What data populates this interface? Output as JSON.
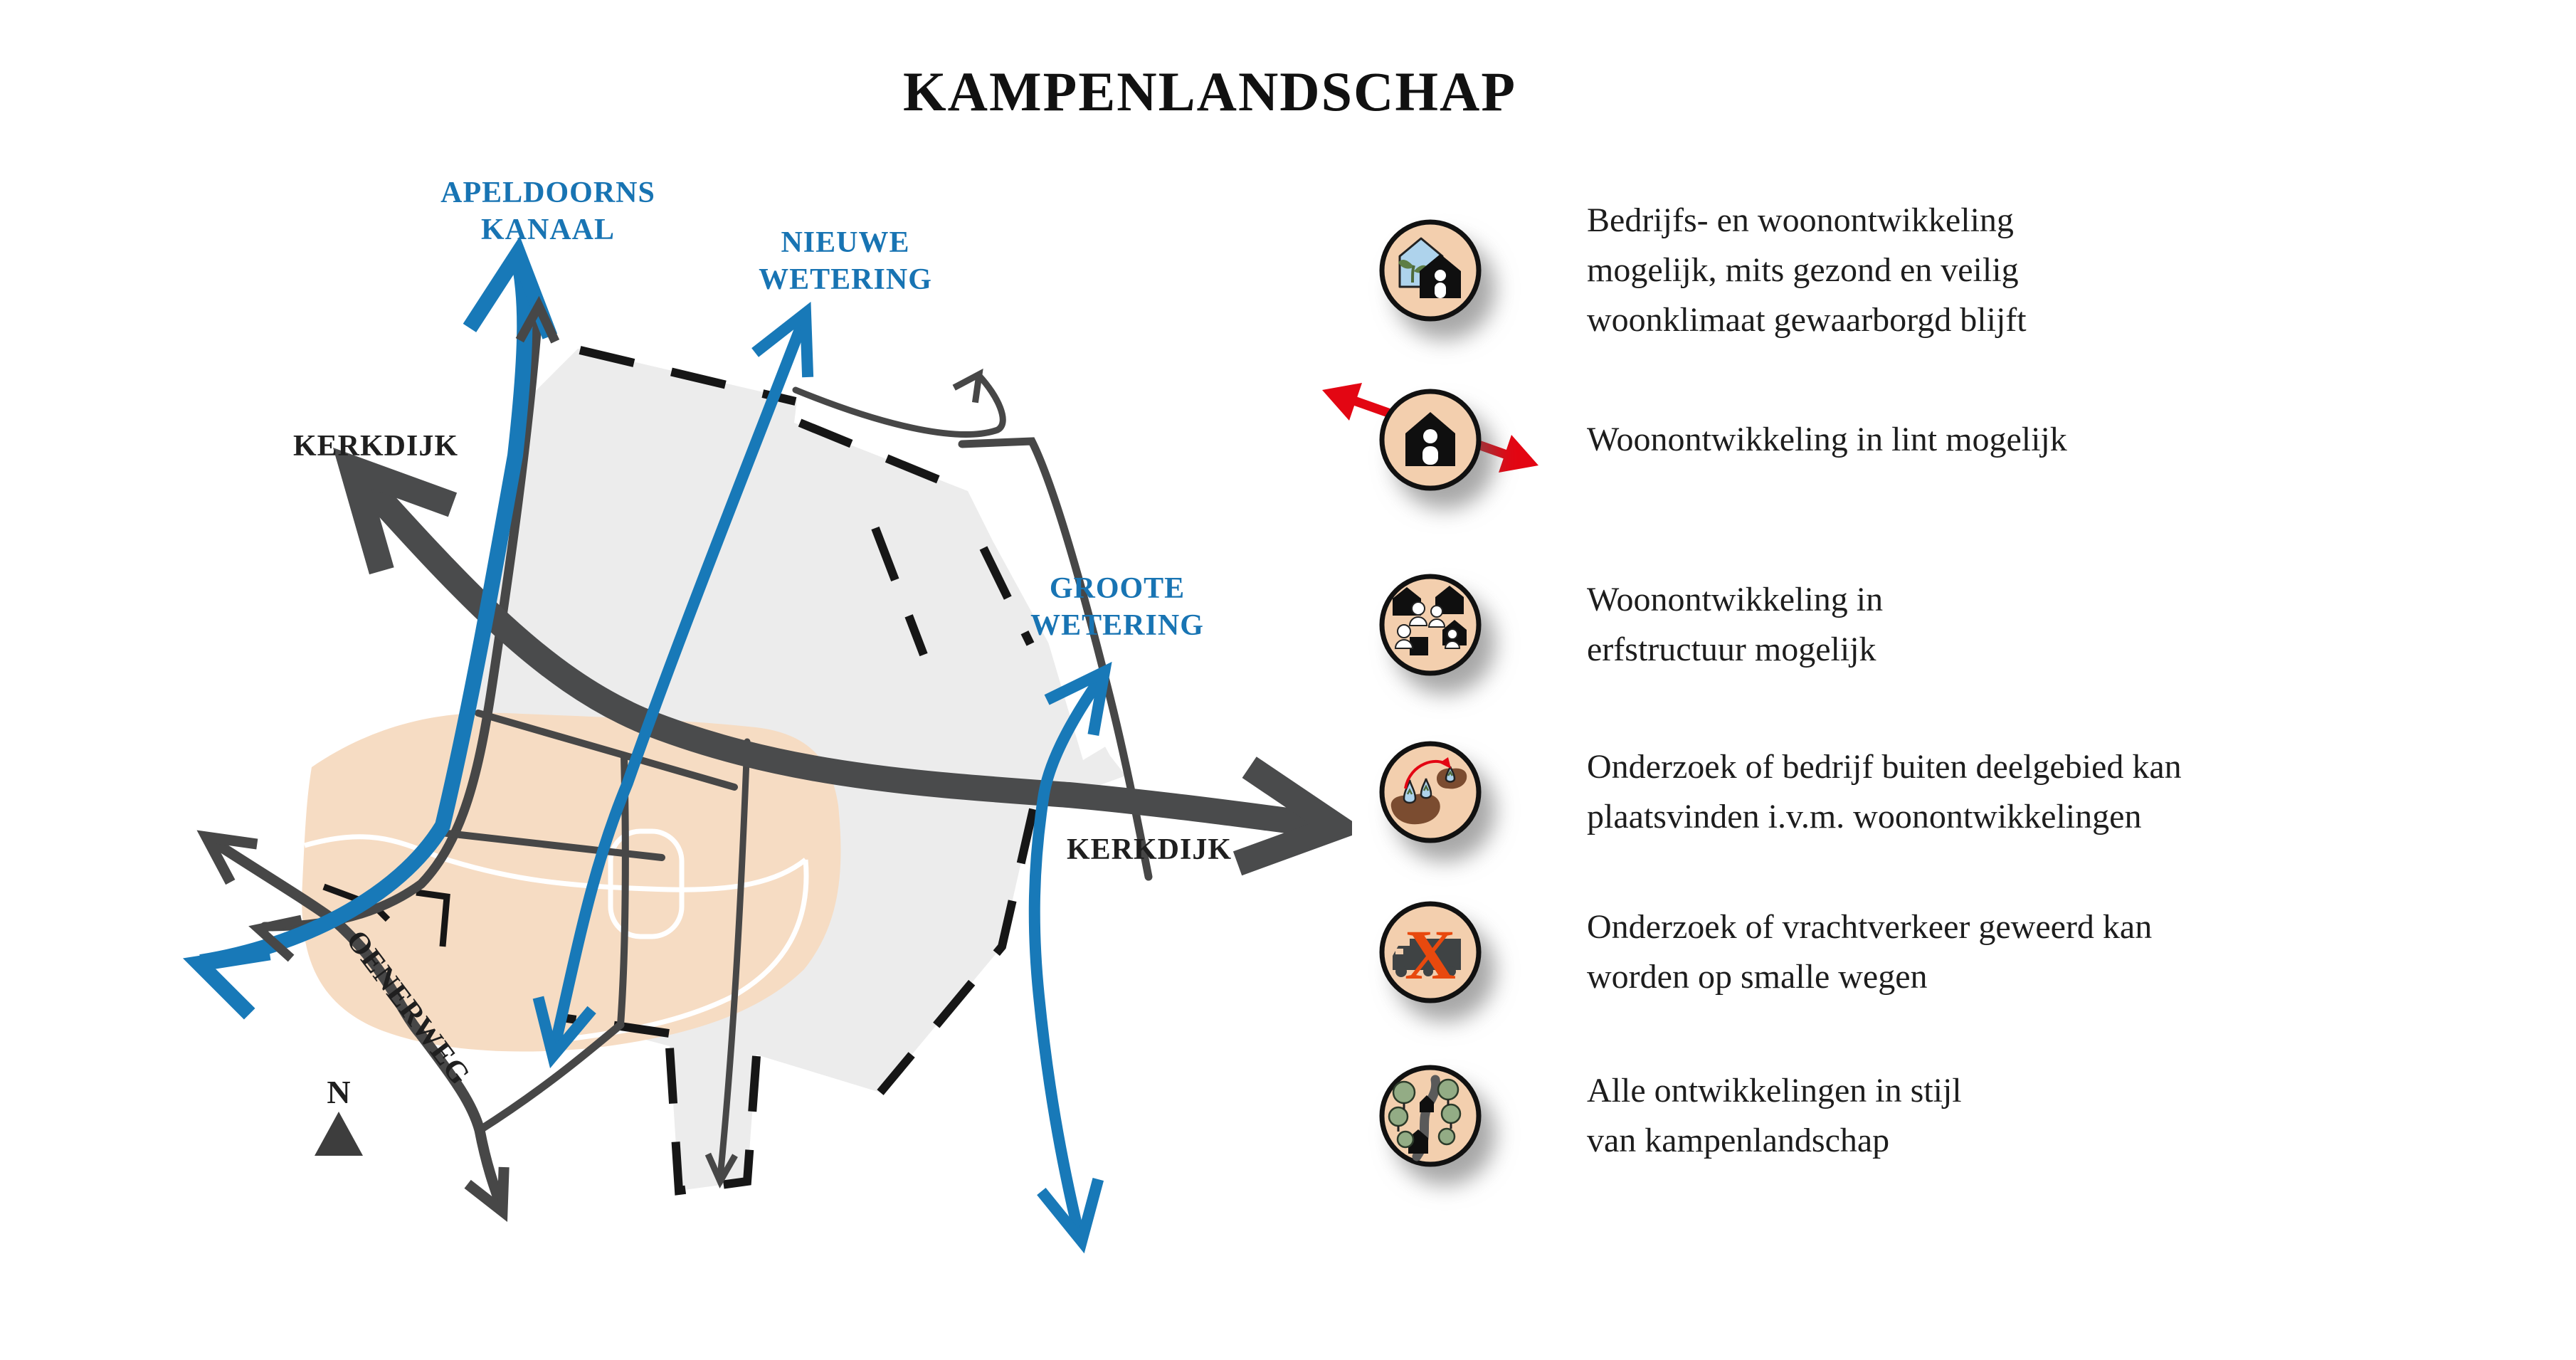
{
  "title": "KAMPENLANDSCHAP",
  "map": {
    "labels": {
      "apeldoorns_kanaal": [
        "APELDOORNS",
        "KANAAL"
      ],
      "nieuwe_wetering": [
        "NIEUWE",
        "WETERING"
      ],
      "groote_wetering": [
        "GROOTE",
        "WETERING"
      ],
      "kerkdijk_northwest": "KERKDIJK",
      "kerkdijk_east": "KERKDIJK",
      "oenerweg": "OENERWEG",
      "compass_north": "N"
    },
    "colors": {
      "waterway_blue": "#1879b8",
      "road_gray": "#4a4b4c",
      "area_gray": "#ececec",
      "area_peach": "#f6dcc3",
      "dash_black": "#161616"
    }
  },
  "legend": {
    "items": [
      {
        "icon": "business-and-housing-icon",
        "lines": [
          "Bedrijfs- en woonontwikkeling",
          "mogelijk, mits gezond en veilig",
          "woonklimaat gewaarborgd blijft"
        ]
      },
      {
        "icon": "housing-in-ribbon-icon",
        "lines": [
          "Woonontwikkeling in lint mogelijk"
        ]
      },
      {
        "icon": "housing-in-farmyard-icon",
        "lines": [
          "Woonontwikkeling in",
          "erfstructuur mogelijk"
        ]
      },
      {
        "icon": "relocate-business-icon",
        "lines": [
          "Onderzoek of bedrijf buiten deelgebied kan",
          "plaatsvinden i.v.m. woonontwikkelingen"
        ]
      },
      {
        "icon": "no-truck-traffic-icon",
        "cross": "X",
        "lines": [
          "Onderzoek of vrachtverkeer geweerd kan",
          "worden op smalle wegen"
        ]
      },
      {
        "icon": "landscape-style-icon",
        "lines": [
          "Alle ontwikkelingen in stijl",
          "van kampenlandschap"
        ]
      }
    ],
    "colors": {
      "icon_background": "#f3cfae",
      "arrow_red": "#e30613",
      "cross_orange": "#e8490e"
    }
  }
}
